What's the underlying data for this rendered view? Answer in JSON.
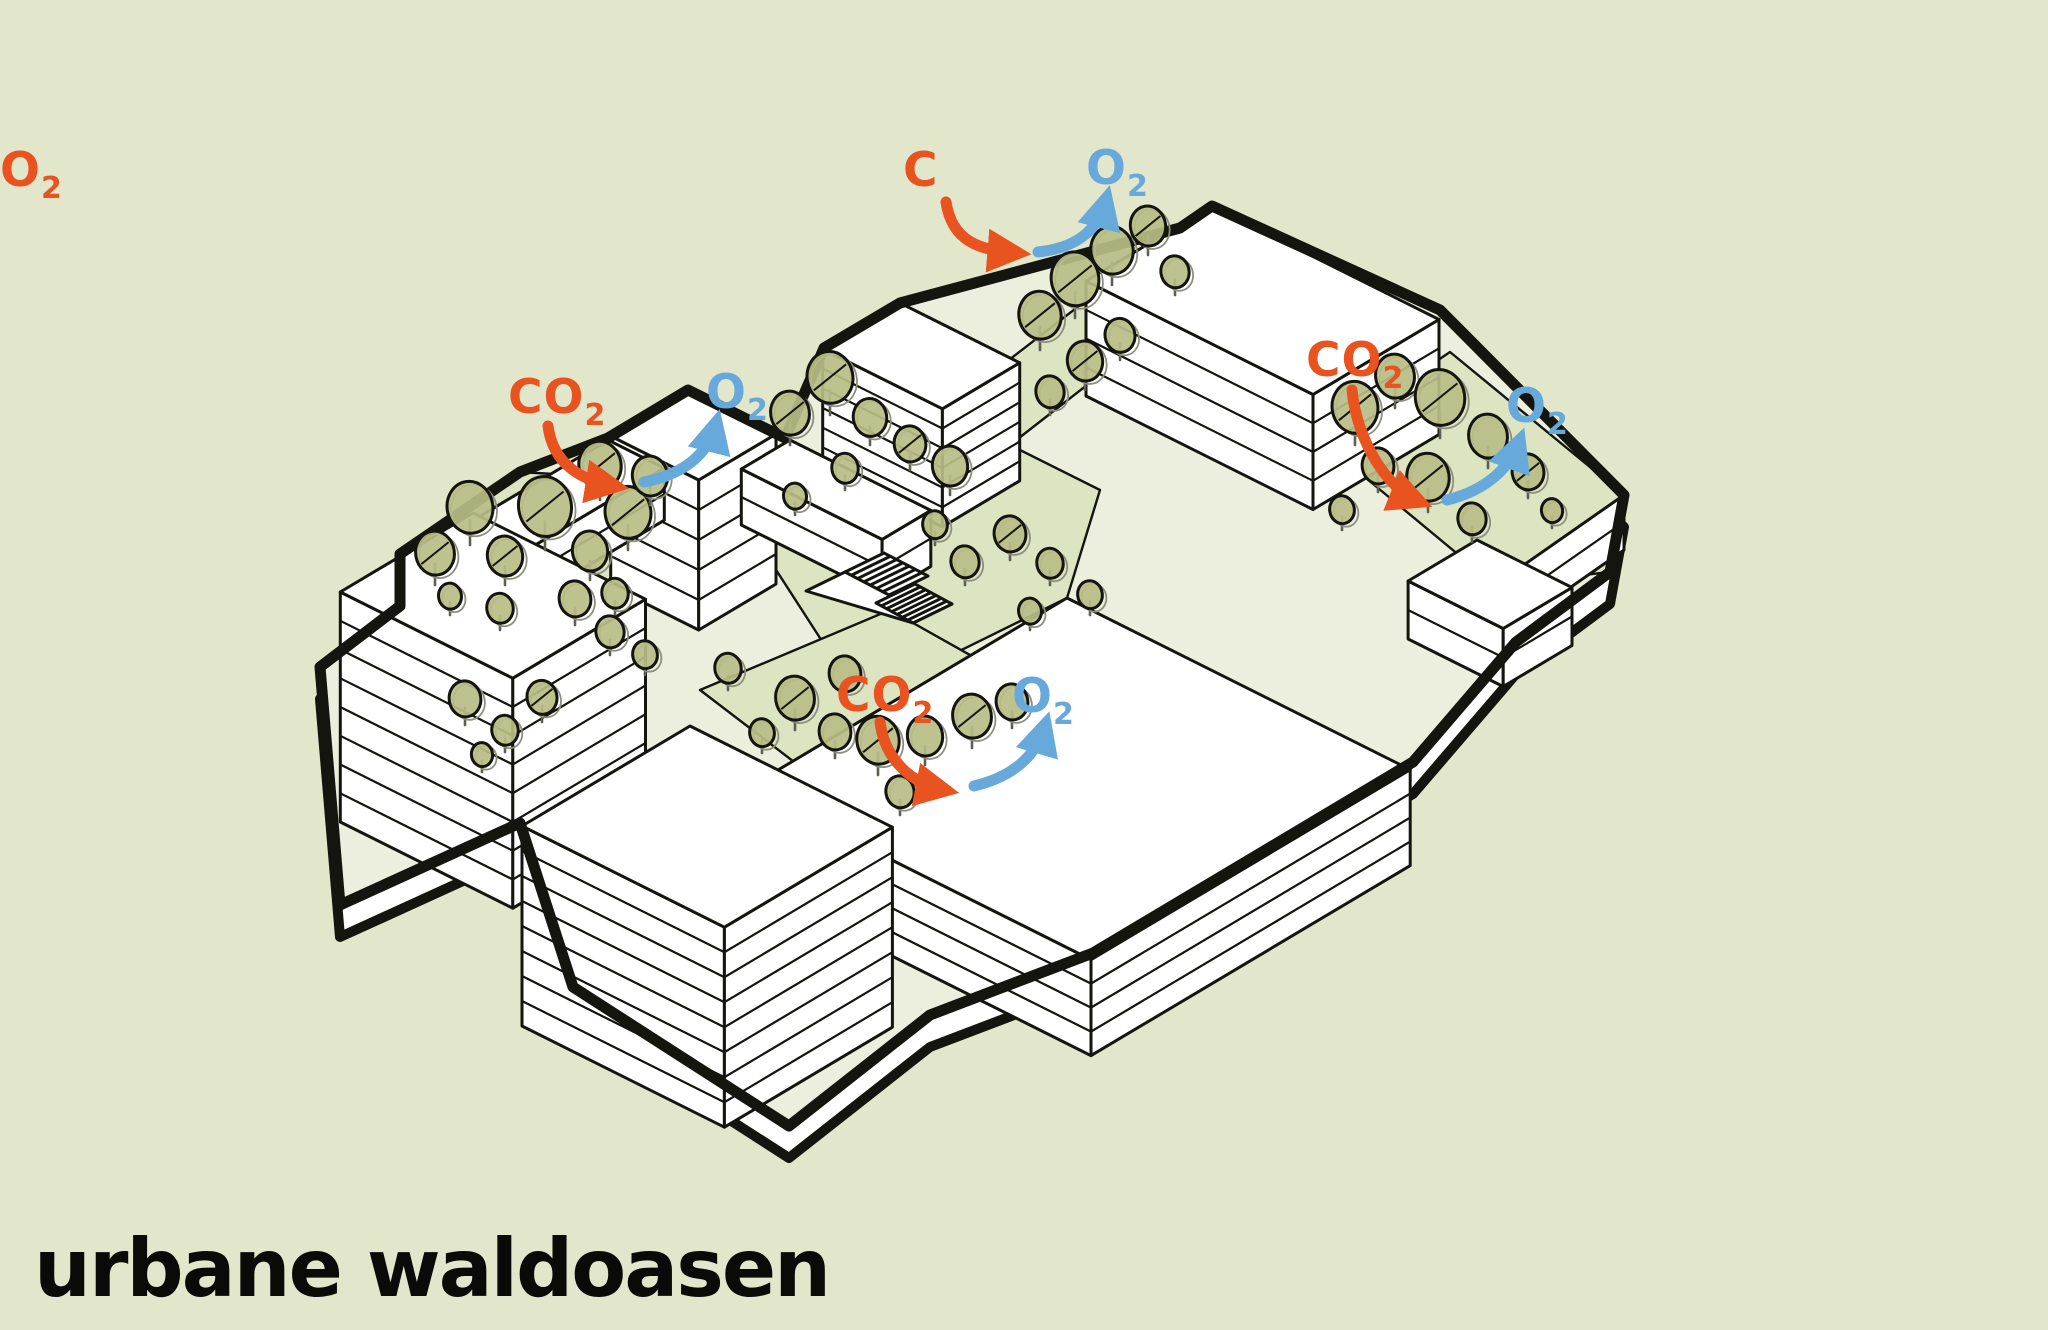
{
  "title": "urbane waldoasen",
  "gas_labels": {
    "co2_base": "CO",
    "co2_sub": "2",
    "o2_base": "O",
    "o2_sub": "2"
  },
  "gas_exchange_pairs": [
    {
      "location": "top-center"
    },
    {
      "location": "upper-left"
    },
    {
      "location": "right"
    },
    {
      "location": "bottom-center"
    }
  ],
  "colors": {
    "background": "#E2E6CB",
    "ground": "#EDEFDE",
    "courtyard": "#DCE4C1",
    "canopy": "#B9BD86",
    "trunk": "#5E5E52",
    "echo": "#8E8E80",
    "ink": "#15150F",
    "co2": "#E8531F",
    "o2": "#68A9DC",
    "title": "#0A0A08"
  }
}
